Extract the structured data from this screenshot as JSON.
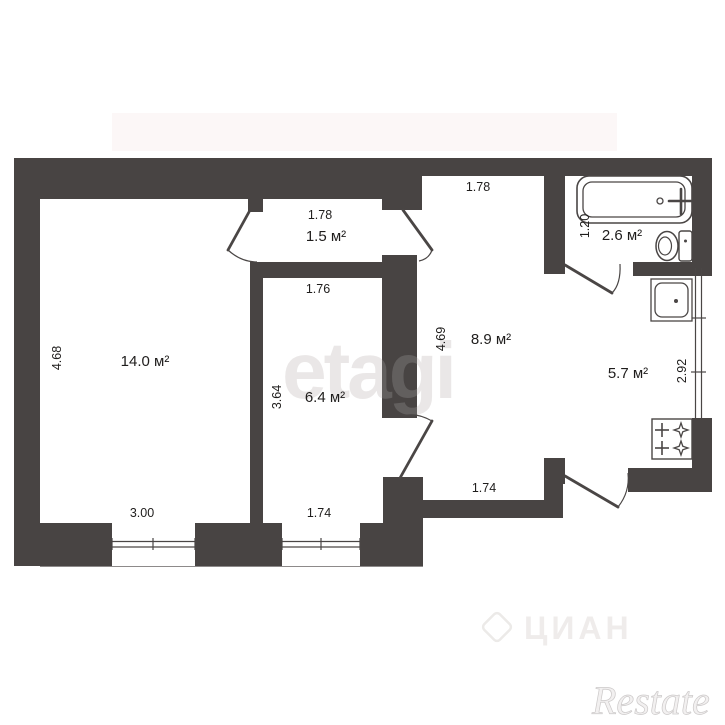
{
  "colors": {
    "wall": "#484443",
    "line": "#4a4645",
    "text": "#1f1d1c",
    "wm": "#e7e4e3"
  },
  "plan": {
    "rooms": [
      {
        "name": "living-room",
        "area": "14.0 м²",
        "dim_bottom": "3.00",
        "dim_left": "4.68"
      },
      {
        "name": "closet",
        "area": "1.5 м²",
        "dim_top": "1.78"
      },
      {
        "name": "bedroom",
        "area": "6.4 м²",
        "dim_top": "1.76",
        "dim_left": "3.64",
        "dim_bottom": "1.74"
      },
      {
        "name": "hallway",
        "area": "8.9 м²",
        "dim_top": "1.78",
        "dim_left": "4.69",
        "dim_bottom": "1.74"
      },
      {
        "name": "bathroom",
        "area": "2.6 м²",
        "dim_left": "1.20"
      },
      {
        "name": "kitchen",
        "area": "5.7 м²",
        "dim_right": "2.92"
      }
    ],
    "fixtures": [
      "bathtub",
      "toilet",
      "sink",
      "gas-stove"
    ]
  },
  "watermarks": {
    "center": "etagi",
    "portal": "ЦИАН",
    "corner": "Restate"
  }
}
